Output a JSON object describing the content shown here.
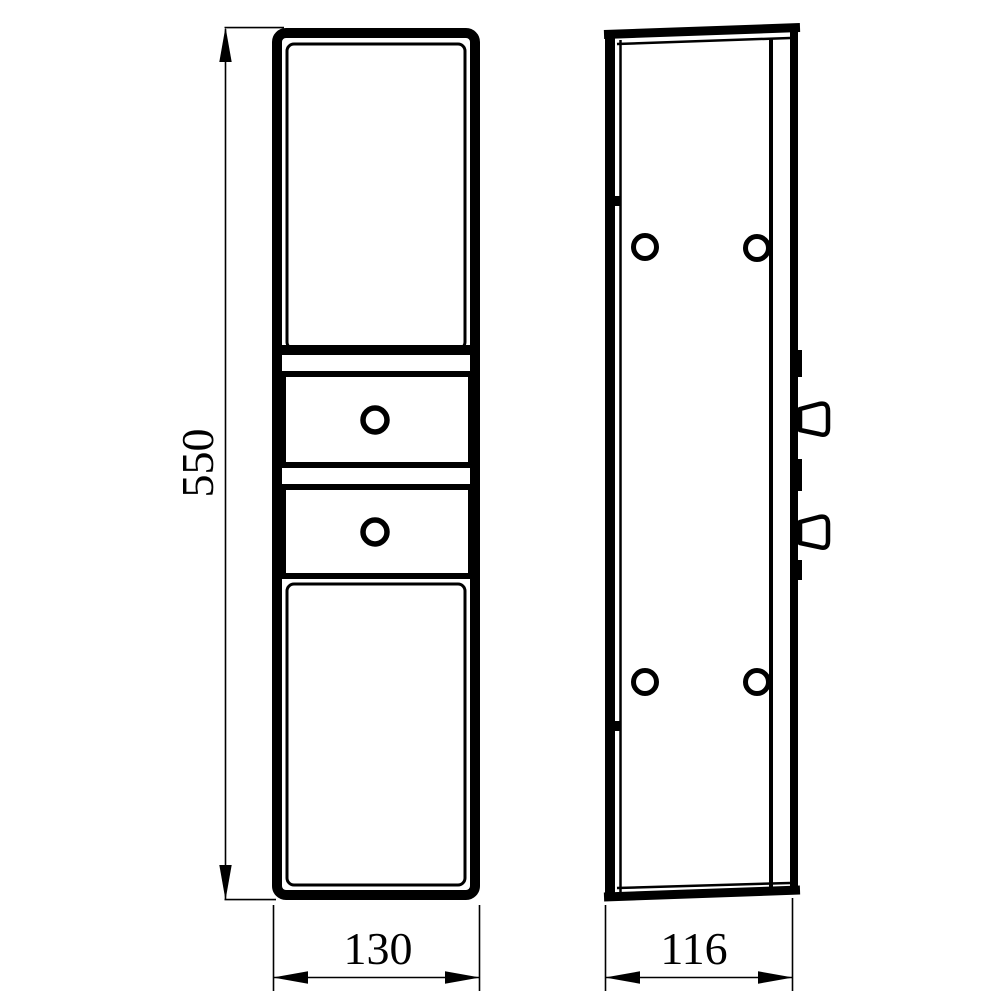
{
  "drawing": {
    "kind": "technical-drawing",
    "subject": "tall-cabinet-two-views",
    "line_color": "#000000",
    "background_color": "#ffffff"
  },
  "dimensions": {
    "height": {
      "value": "550"
    },
    "width": {
      "value": "130"
    },
    "depth": {
      "value": "116"
    }
  }
}
